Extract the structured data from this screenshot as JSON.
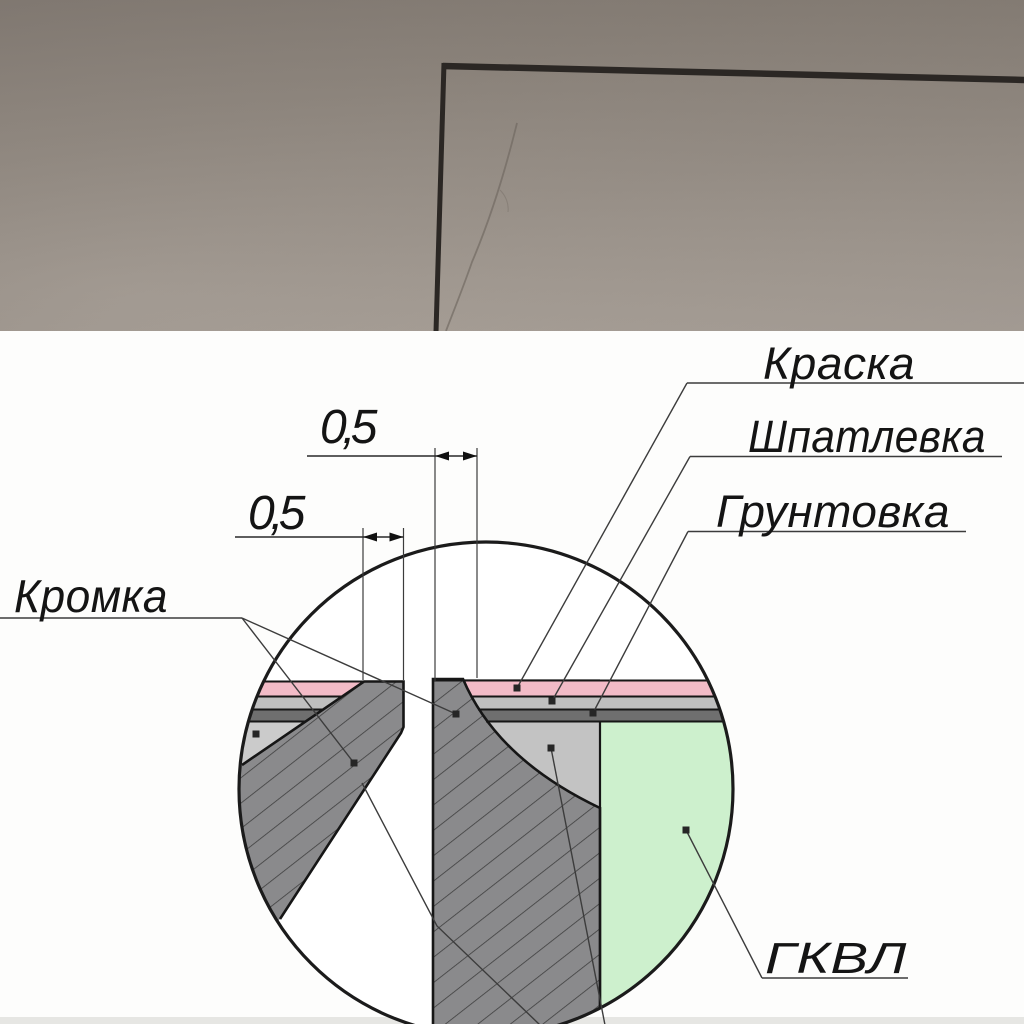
{
  "photo": {
    "wall_color_top": "#857C74",
    "wall_color_bottom": "#ABA29A",
    "shadow_gap_color": "#2B2724"
  },
  "drawing": {
    "labels": {
      "kromka": "Кромка",
      "kraska": "Краска",
      "shpatlevka": "Шпатлевка",
      "gruntovka": "Грунтовка",
      "gkvl": "ГКВЛ"
    },
    "dimensions": {
      "top_gap": "0,5",
      "left_gap": "0,5"
    },
    "colors": {
      "paint_pink": "#F2BBC7",
      "filler_light": "#BFBFBF",
      "primer_dark": "#6F6F6F",
      "putty_gray": "#C3C3C3",
      "putty_light": "#CBCBCB",
      "board_gray": "#8A8A8C",
      "gkvl_green": "#CDF0CD"
    }
  }
}
